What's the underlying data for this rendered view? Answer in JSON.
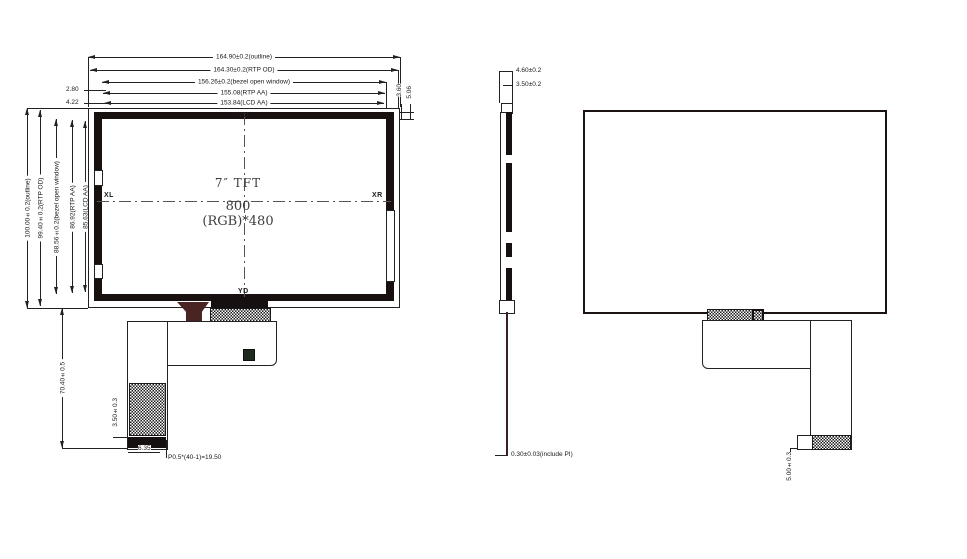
{
  "front_view": {
    "center": {
      "line1": "7″  TFT",
      "line2": "800 (RGB)*480"
    },
    "probes": {
      "top": "YU",
      "bottom": "YD",
      "left": "XL",
      "right": "XR"
    },
    "h_dims": [
      "164.90±0.2(outline)",
      "164.30±0.2(RTP OD)",
      "156.26±0.2(bezel open window)",
      "155.08(RTP AA)",
      "153.84(LCD AA)"
    ],
    "v_dims": [
      "100.00±0.2(outline)",
      "99.40±0.2(RTP OD)",
      "88.56±0.2(bezel open window)",
      "86.92(RTP AA)",
      "85.63(LCD AA)"
    ],
    "left_offsets": [
      "2.80",
      "4.22"
    ],
    "right_offsets": [
      "3.60",
      "5.06"
    ],
    "fpc": {
      "length_dim": "70.40±0.5",
      "stiffener_dim": "3.50±0.3",
      "offset_dim": "6.35",
      "pitch_dim": "P0.5*(40-1)=19.50",
      "pin_first": "1",
      "pin_last": "4"
    }
  },
  "side_view": {
    "thickness_dims": [
      "4.60±0.2",
      "3.50±0.2"
    ],
    "fpc_thickness_dim": "0.30±0.03(include PI)"
  },
  "back_view": {
    "tab_dim": "5.00±0.3"
  }
}
